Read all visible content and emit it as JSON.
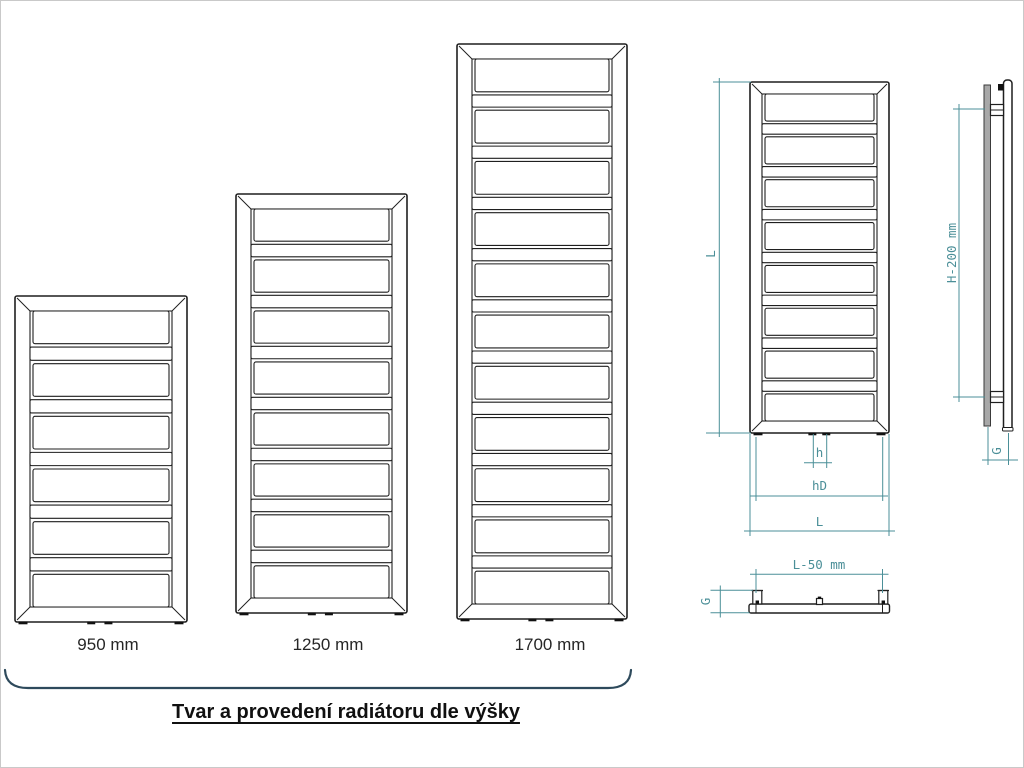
{
  "title": {
    "text": "Tvar a provedení radiátoru dle výšky"
  },
  "colors": {
    "drawing_line": "#1f1f1f",
    "dimension": "#4b8f98",
    "bracket": "#2e4a5c",
    "side_panel_fill": "#a8a8a8"
  },
  "radiators": [
    {
      "label": "950 mm",
      "x": 14,
      "y": 295,
      "w": 172,
      "h": 326,
      "inset": 15,
      "panels": 6
    },
    {
      "label": "1250 mm",
      "x": 235,
      "y": 193,
      "w": 171,
      "h": 419,
      "inset": 15,
      "panels": 8
    },
    {
      "label": "1700 mm",
      "x": 456,
      "y": 43,
      "w": 170,
      "h": 575,
      "inset": 15,
      "panels": 11
    }
  ],
  "front_view": {
    "x": 749,
    "y": 81,
    "w": 139,
    "h": 351,
    "inset": 12,
    "panels": 8,
    "dims": {
      "height_label": "L",
      "width_label": "L",
      "bracket_span_label": "hD",
      "pipe_span_label": "h"
    }
  },
  "side_view": {
    "dims": {
      "height_label": "H-200 mm",
      "depth_label": "G"
    }
  },
  "top_view": {
    "dims": {
      "width_label": "L-50 mm",
      "depth_label": "G"
    }
  }
}
